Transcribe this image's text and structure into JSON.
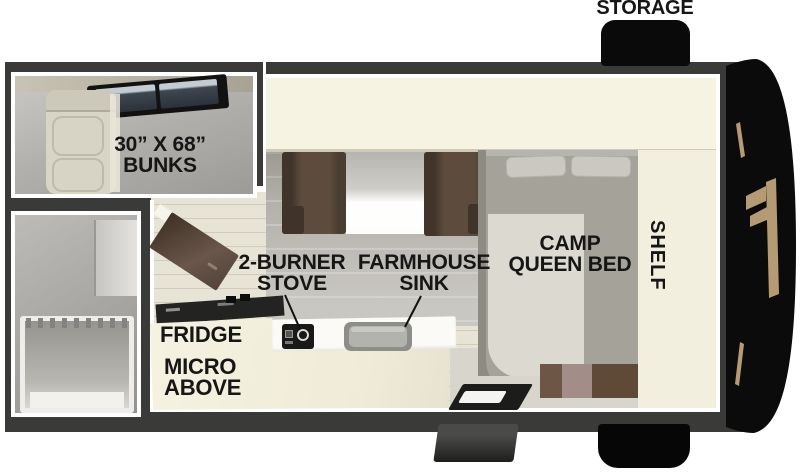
{
  "floorplan": {
    "labels": {
      "storage": "STORAGE",
      "bunks_size": "30” X 68”",
      "bunks": "BUNKS",
      "camp": "CAMP",
      "queen_bed": "QUEEN BED",
      "shelf": "SHELF",
      "stove_l1": "2-BURNER",
      "stove_l2": "STOVE",
      "sink_l1": "FARMHOUSE",
      "sink_l2": "SINK",
      "fridge": "FRIDGE",
      "micro_l1": "MICRO",
      "micro_l2": "ABOVE"
    },
    "colors": {
      "wall": "#3a3a38",
      "trim": "#ffffff",
      "cabinet_cream": "#f7f3e2",
      "floor_beige": "#e8e4d5",
      "bench_brown": "#5d4c3e",
      "bed_gray": "#a5a29a",
      "blanket": "#dcd9d0",
      "nose_black": "#0b0b0b",
      "emblem_tan": "#b49b74",
      "label_text": "#161616"
    }
  }
}
